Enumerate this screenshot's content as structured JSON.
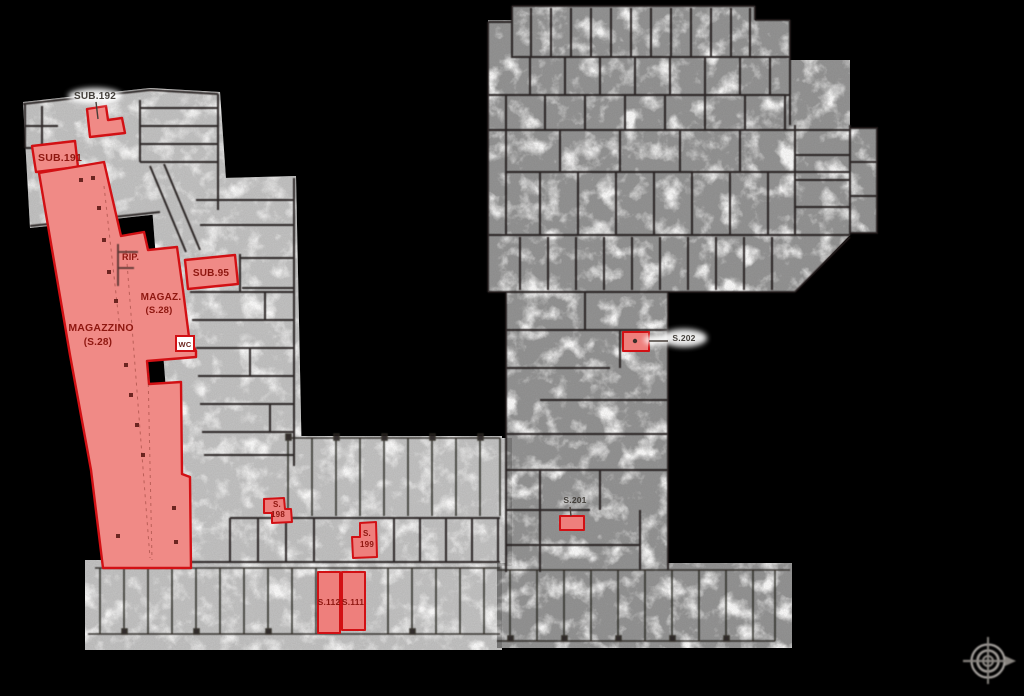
{
  "colors": {
    "background": "#000000",
    "paper": "#ffffff",
    "highlight_fill": "#f08a86",
    "highlight_stroke": "#d21014",
    "label_red": "#8e1710",
    "label_dark": "#44403b",
    "compass_gray": "#b2aeaa"
  },
  "plan": {
    "labels": {
      "sub192": "SUB.192",
      "sub191": "SUB.191",
      "rip": "RIP.",
      "sub95": "SUB.95",
      "magaz_line1": "MAGAZ.",
      "magaz_line2": "(S.28)",
      "magazzino_line1": "MAGAZZINO",
      "magazzino_line2": "(S.28)",
      "wc": "WC",
      "s198_line1": "S.",
      "s198_line2": "198",
      "s199_line1": "S.",
      "s199_line2": "199",
      "s112": "S.112",
      "s111": "S.111",
      "s201": "S.201",
      "s202": "S.202"
    },
    "icons": {
      "compass": "north-compass-icon"
    }
  }
}
